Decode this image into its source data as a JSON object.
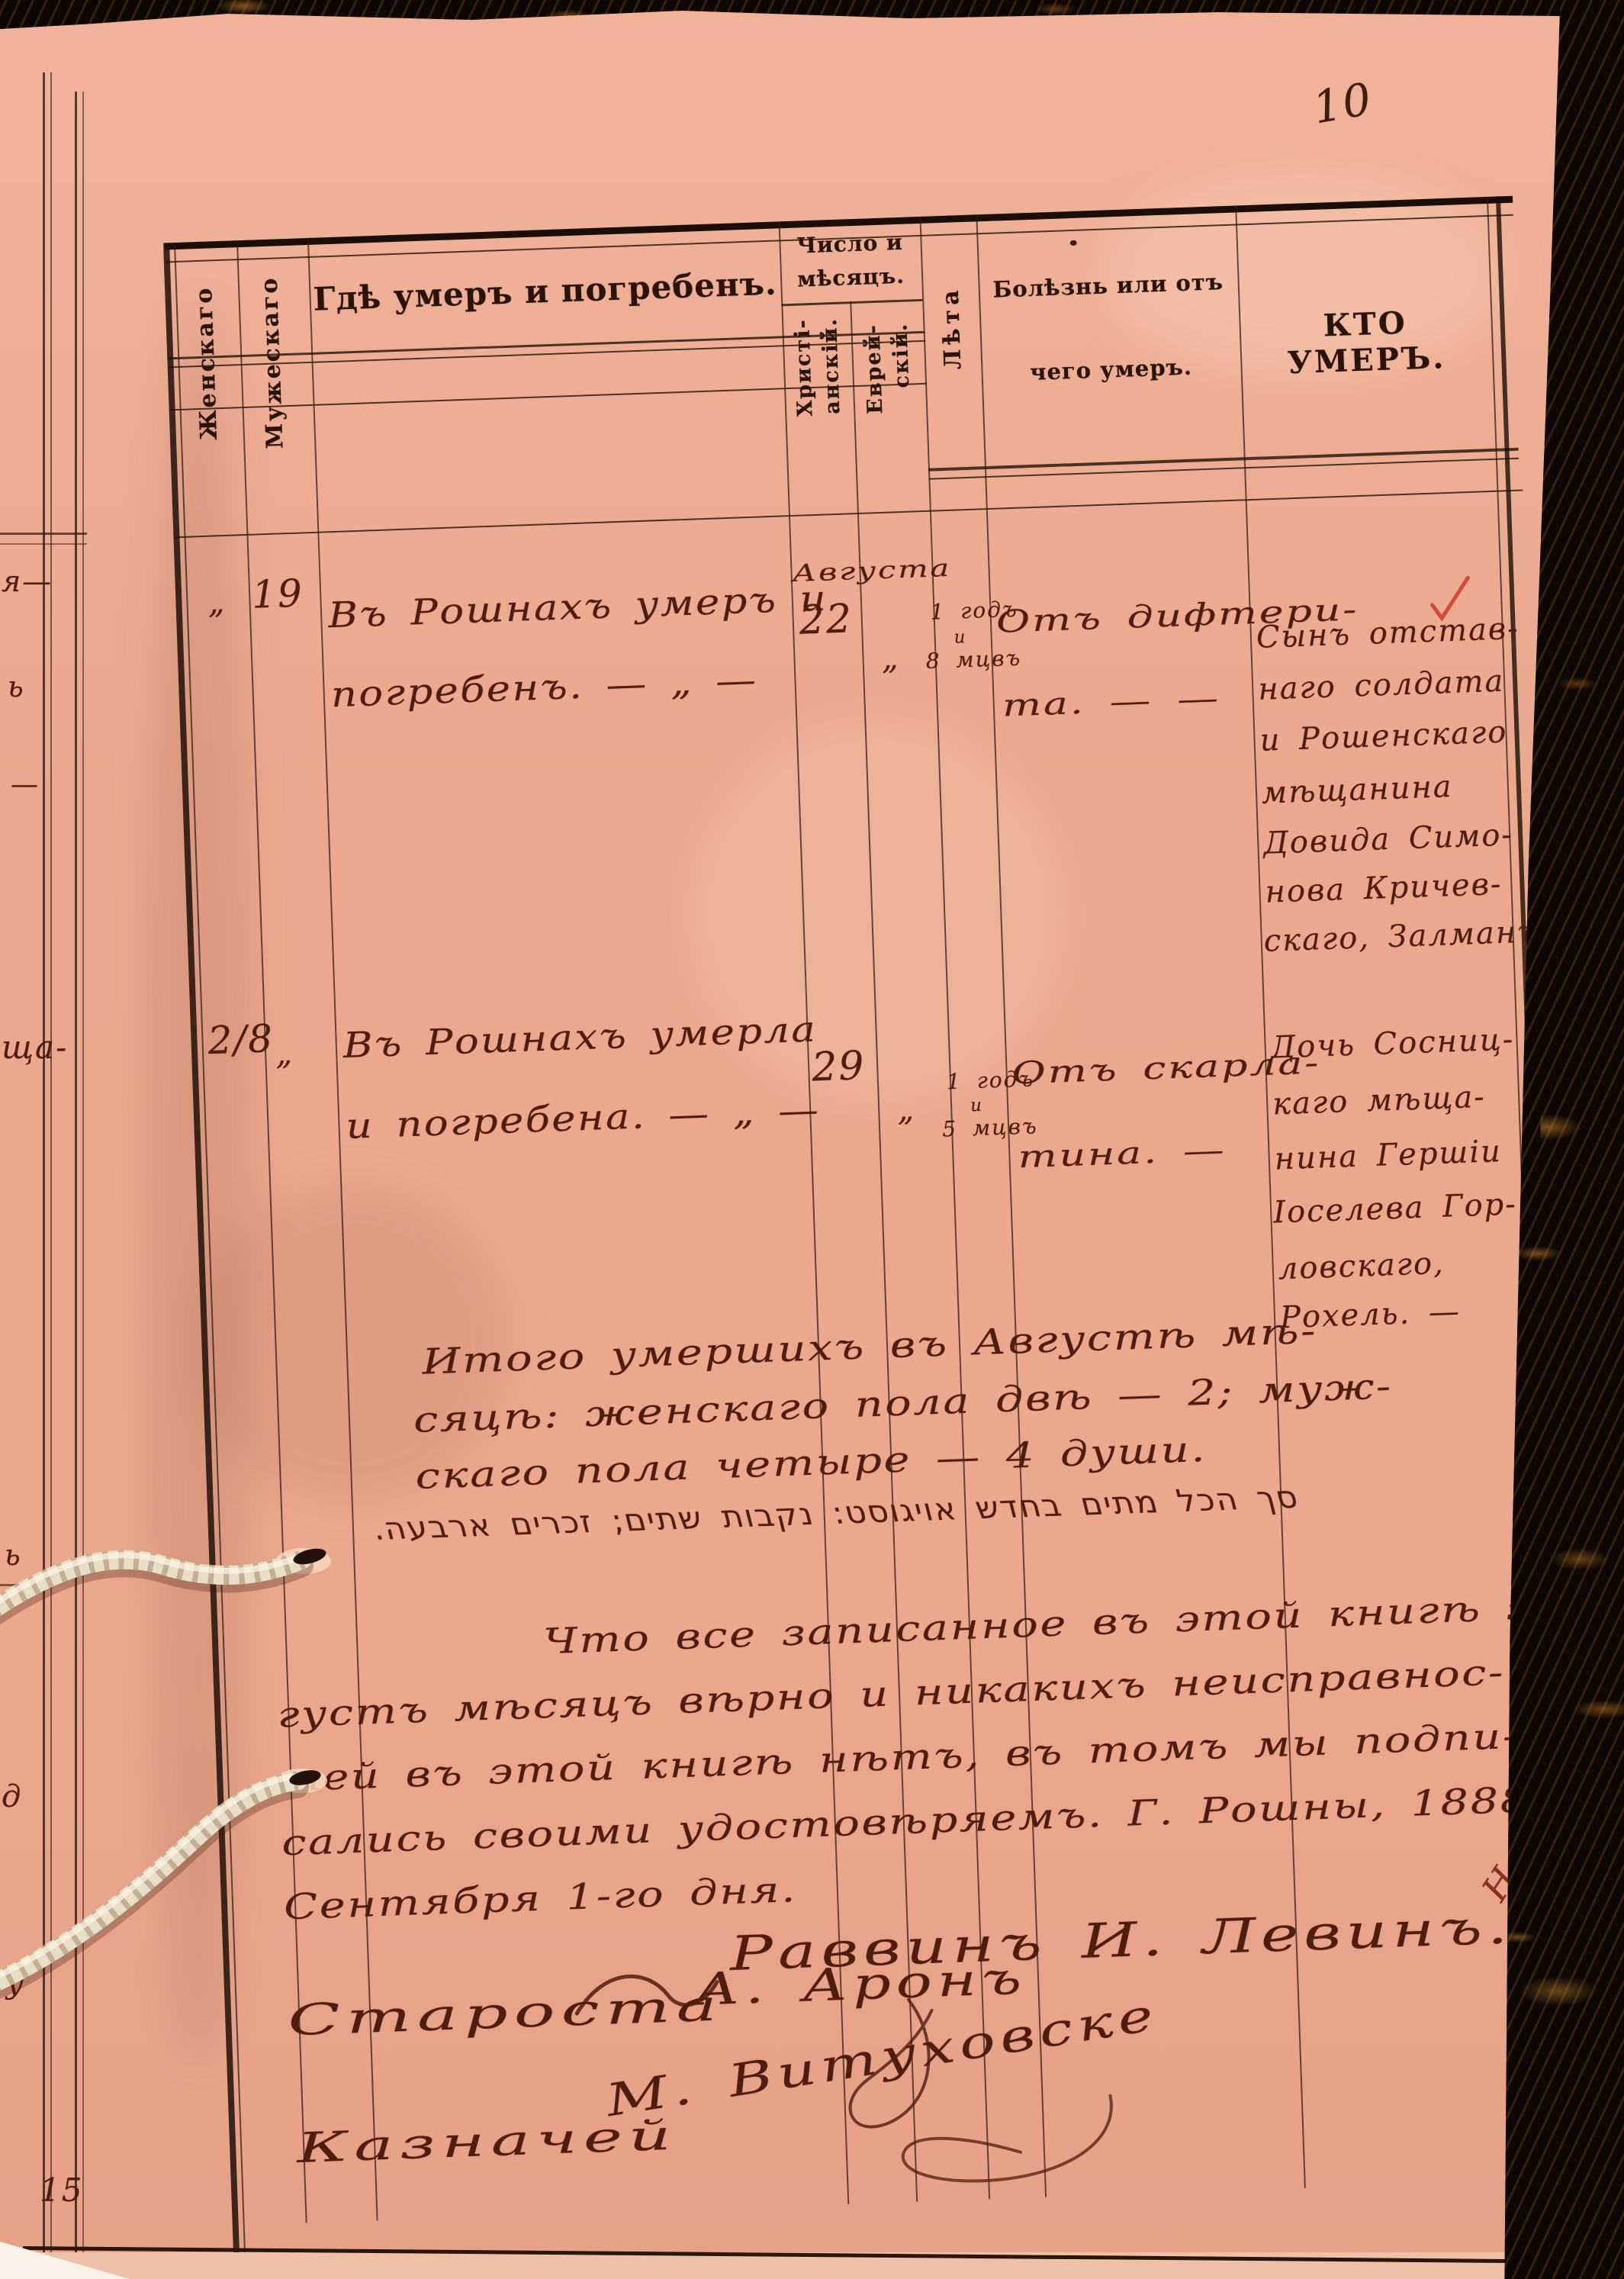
{
  "page": {
    "number": "10"
  },
  "header": {
    "female": "Женскаго",
    "male": "Мужескаго",
    "where": "Гдѣ умеръ и погребенъ.",
    "date_line1": "Число и",
    "date_line2": "мѣсяцъ.",
    "date_christian_1": "Христі-",
    "date_christian_2": "анскій.",
    "date_jewish_1": "Еврей-",
    "date_jewish_2": "скій.",
    "age": "Лѣта",
    "cause_line1": "Болѣзнь или отъ",
    "cause_line2": "чего умеръ.",
    "who": "КТО УМЕРЪ."
  },
  "entries": [
    {
      "female_no": "„",
      "male_no": "19",
      "month": "Августа",
      "day_christian": "22",
      "day_jewish": "„",
      "where_lines": [
        "Въ Рошнахъ умеръ и",
        "погребенъ. — „ —"
      ],
      "age_lines": [
        "1 годъ",
        "и",
        "8 мцвъ"
      ],
      "cause_lines": [
        "Отъ дифтери-",
        "та. — —"
      ],
      "who_lines": [
        "Сынъ отстав-",
        "наго солдата",
        "и Рошенскаго",
        "мѣщанина",
        "Довида Симо-",
        "нова Кричев-",
        "скаго, Залманъ"
      ]
    },
    {
      "female_no": "2/8",
      "male_no": "„",
      "day_christian": "29",
      "day_jewish": "„",
      "where_lines": [
        "Въ Рошнахъ умерла",
        "и погребена. — „ —"
      ],
      "age_lines": [
        "1 годъ",
        "и",
        "5 мцвъ"
      ],
      "cause_lines": [
        "Отъ скарла-",
        "тина. —"
      ],
      "who_lines": [
        "Дочь Сосниц-",
        "каго мѣща-",
        "нина Гершіи",
        "Іоселева Гор-",
        "ловскаго,",
        "Рохель. —"
      ]
    }
  ],
  "summary": {
    "lines": [
      "Итого умершихъ въ Августѣ мѣ-",
      "сяцѣ: женскаго пола двѣ — 2; муж-",
      "скаго пола четыре — 4 души."
    ],
    "hebrew": "סך הכל מתים בחדש אויגוסט: נקבות שתים; זכרים ארבעה."
  },
  "attestation": {
    "lines": [
      "Что все записанное въ этой книгѣ за Ав-",
      "густъ мѣсяцъ вѣрно и никакихъ неисправнос-",
      "тей въ этой книгѣ нѣтъ, въ томъ мы подпи-",
      "сались своими удостовѣряемъ. Г. Рошны, 1888 года",
      "Сентября 1-го дня."
    ]
  },
  "signatures": {
    "rabbi": "Раввинъ И. Левинъ.",
    "margin_mark": "Нов",
    "elder_label": "Староста",
    "elder_name": "А. Аронъ",
    "treasurer_label": "Казначей",
    "treasurer_name": "М. Витуховске"
  },
  "left_strip": {
    "fragments": [
      "я—",
      "ь",
      "—",
      "ща-",
      "ь",
      "д",
      "у",
      "15"
    ]
  },
  "colors": {
    "paper": "#edab90",
    "ink": "#4f1d0e",
    "print": "#2a140a",
    "binding": "#150d07",
    "cord": "#e8ddc6",
    "check_red": "#cf3a2a"
  }
}
